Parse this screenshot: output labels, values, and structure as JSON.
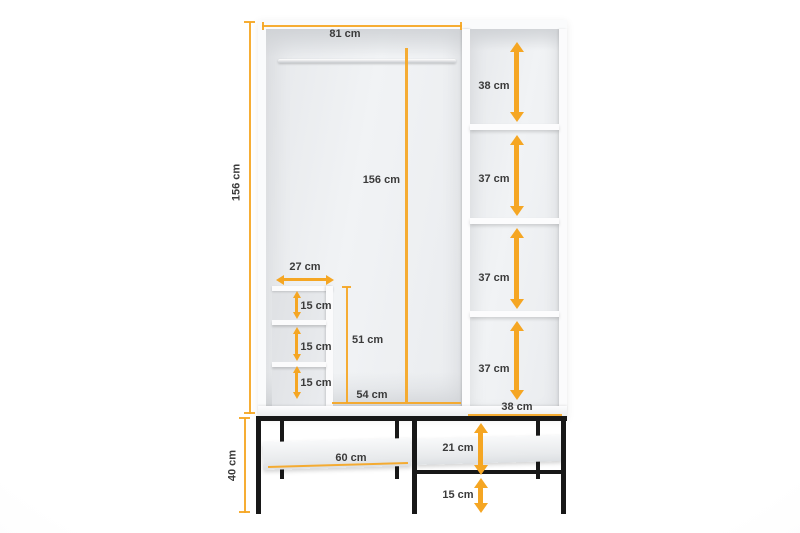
{
  "diagram": {
    "title": "wardrobe-dimension-diagram",
    "accent_color": "#F5A623",
    "frame_color": "#181818",
    "unit": "cm",
    "overall": {
      "height": "156 cm",
      "base_height": "40 cm"
    },
    "hanging_section": {
      "width": "81 cm",
      "interior_height": "156 cm",
      "open_floor_width": "54 cm"
    },
    "right_column": {
      "gaps": [
        "38 cm",
        "37 cm",
        "37 cm",
        "37 cm"
      ],
      "width": "38 cm"
    },
    "cubby_unit": {
      "width": "27 cm",
      "height": "51 cm",
      "gaps": [
        "15 cm",
        "15 cm",
        "15 cm"
      ]
    },
    "base": {
      "shelf_width": "60 cm",
      "gap_above_shelf": "21 cm",
      "gap_below_shelf": "15 cm"
    }
  }
}
